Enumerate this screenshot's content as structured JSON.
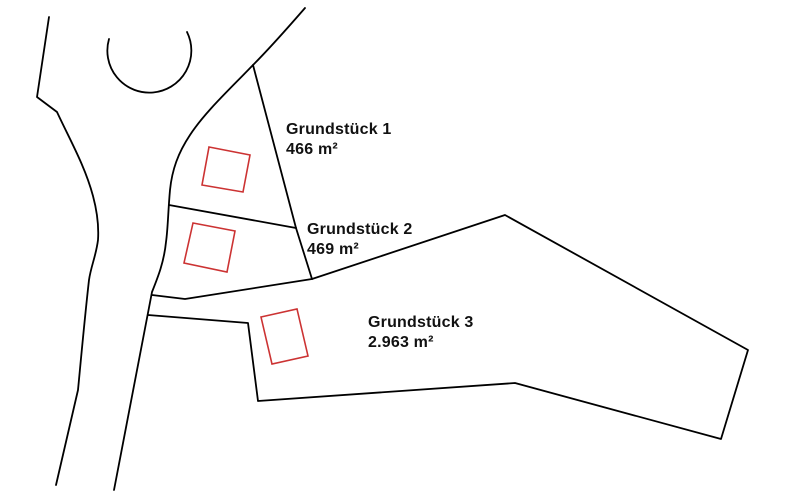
{
  "map": {
    "background_color": "#ffffff",
    "line_color": "#000000",
    "line_width": 1.8,
    "building_color": "#cc3333",
    "building_line_width": 1.6,
    "paths": [
      {
        "name": "road-edge-left",
        "d": "M49,17 L37,97 L57,112 C70,140 85,166 93,196 C97,211 99,225 98,240 C96,256 91,266 89,280 C85,315 82,348 78,390 L56,485"
      },
      {
        "name": "cul-de-sac-arc",
        "d": "M109,39 A42,42 0 1 0 187,32"
      },
      {
        "name": "road-edge-right",
        "d": "M305,8 C285,31 267,51 253,65 C230,89 205,112 190,135 C178,153 172,170 170,190 C168,212 168,228 166,242 C164,262 158,277 152,292 L114,490"
      },
      {
        "name": "parcel1-east-boundary",
        "d": "M253,65 L296,228"
      },
      {
        "name": "parcel1-parcel2-divider",
        "d": "M169,205 L296,228"
      },
      {
        "name": "parcel2-east-boundary",
        "d": "M296,228 L312,279"
      },
      {
        "name": "parcel2-south-boundary",
        "d": "M152,295 L185,299 L312,279"
      },
      {
        "name": "parcel3-outline",
        "d": "M312,279 L505,215 L748,350 L721,439 L515,383 L258,401 L248,323 L148,315"
      }
    ],
    "buildings": [
      {
        "name": "building-parcel-1",
        "points": "209,147 250,155 243,192 202,185"
      },
      {
        "name": "building-parcel-2",
        "points": "193,223 235,231 227,272 184,263"
      },
      {
        "name": "building-parcel-3",
        "points": "261,317 297,309 308,356 272,364"
      }
    ]
  },
  "parcels": [
    {
      "name": "Grundstück 1",
      "area": "466 m²"
    },
    {
      "name": "Grundstück 2",
      "area": "469 m²"
    },
    {
      "name": "Grundstück 3",
      "area": "2.963 m²"
    }
  ]
}
